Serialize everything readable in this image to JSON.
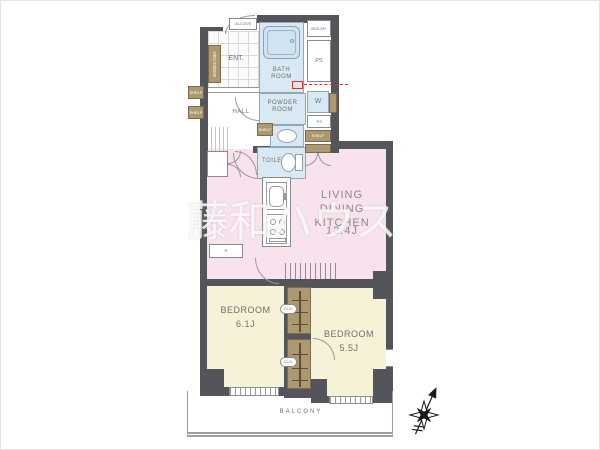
{
  "watermark": "藤和ハウス",
  "labels": {
    "alcove": "ALCOVE",
    "entrance": "ENT.",
    "shoes_cabinet": "SHOES CBD",
    "bathroom": "BATH\nROOM",
    "boiler": "BOILER",
    "pipe_space": "PS",
    "powder_room": "POWDER\nROOM",
    "washer": "W",
    "hall": "HALL",
    "shelf": "SHELF",
    "toilet": "TOILET",
    "refrigerator": "R",
    "living": "LIVING\nDINING KITCHEN",
    "living_size": "12.4J",
    "bedroom": "BEDROOM",
    "bedroom1_size": "6.1J",
    "bedroom2_size": "5.5J",
    "closet": "CLO.",
    "balcony": "BALCONY"
  },
  "icons": {
    "compass": "compass-rose-north-arrow"
  },
  "colors": {
    "wall": "#54555B",
    "wet_room": "#D9E9F4",
    "living": "#F8E2EE",
    "bedroom": "#F5F2D8",
    "cabinet": "#AC9971",
    "label_text": "#6F6F6F",
    "annotation_red": "#D9352A",
    "watermark": "rgba(255,255,255,0.82)",
    "balcony_line": "#9AA0A6"
  }
}
